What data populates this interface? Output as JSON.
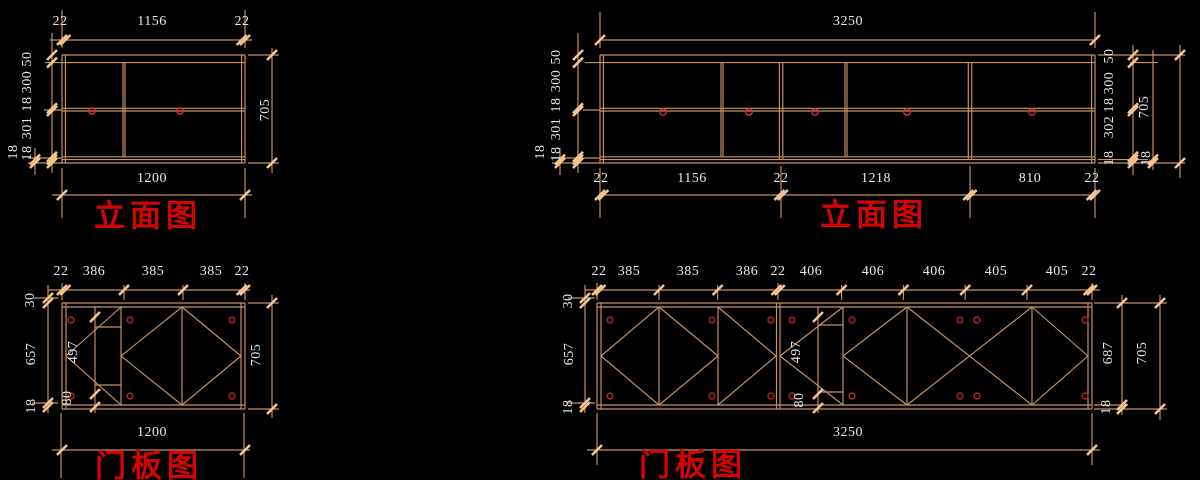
{
  "canvas": {
    "width": 1200,
    "height": 480,
    "background": "#000000"
  },
  "colors": {
    "line": "#C59468",
    "tick": "#F4C48F",
    "dim_text": "#E8E8E8",
    "title_red": "#D40404",
    "handle_red": "#D92B2B",
    "hinge_red": "#9E2323"
  },
  "titles": [
    {
      "text": "立面图",
      "x": 148,
      "y": 216
    },
    {
      "text": "立面图",
      "x": 874,
      "y": 215
    },
    {
      "text": "门板图",
      "x": 149,
      "y": 466
    },
    {
      "text": "门板图",
      "x": 693,
      "y": 465
    }
  ],
  "labels": [
    {
      "t": "22",
      "x": 60,
      "y": 22,
      "r": 0
    },
    {
      "t": "1156",
      "x": 152,
      "y": 22,
      "r": 0
    },
    {
      "t": "22",
      "x": 242,
      "y": 22,
      "r": 0
    },
    {
      "t": "50",
      "x": 28,
      "y": 59,
      "r": -90
    },
    {
      "t": "300",
      "x": 28,
      "y": 82,
      "r": -90
    },
    {
      "t": "18",
      "x": 28,
      "y": 104,
      "r": -90
    },
    {
      "t": "301",
      "x": 28,
      "y": 128,
      "r": -90
    },
    {
      "t": "18",
      "x": 28,
      "y": 153,
      "r": -90
    },
    {
      "t": "18",
      "x": 14,
      "y": 152,
      "r": -90
    },
    {
      "t": "705",
      "x": 266,
      "y": 110,
      "r": -90
    },
    {
      "t": "1200",
      "x": 152,
      "y": 179,
      "r": 0
    },
    {
      "t": "3250",
      "x": 848,
      "y": 22,
      "r": 0
    },
    {
      "t": "50",
      "x": 557,
      "y": 57,
      "r": -90
    },
    {
      "t": "300",
      "x": 557,
      "y": 81,
      "r": -90
    },
    {
      "t": "18",
      "x": 557,
      "y": 105,
      "r": -90
    },
    {
      "t": "301",
      "x": 557,
      "y": 129,
      "r": -90
    },
    {
      "t": "18",
      "x": 557,
      "y": 154,
      "r": -90
    },
    {
      "t": "18",
      "x": 541,
      "y": 152,
      "r": -90
    },
    {
      "t": "50",
      "x": 1110,
      "y": 56,
      "r": -90
    },
    {
      "t": "300",
      "x": 1110,
      "y": 83,
      "r": -90
    },
    {
      "t": "18",
      "x": 1110,
      "y": 105,
      "r": -90
    },
    {
      "t": "302",
      "x": 1110,
      "y": 127,
      "r": -90
    },
    {
      "t": "18",
      "x": 1110,
      "y": 158,
      "r": -90
    },
    {
      "t": "705",
      "x": 1145,
      "y": 107,
      "r": -90
    },
    {
      "t": "18",
      "x": 1147,
      "y": 158,
      "r": -90
    },
    {
      "t": "22",
      "x": 601,
      "y": 179,
      "r": 0
    },
    {
      "t": "1156",
      "x": 692,
      "y": 179,
      "r": 0
    },
    {
      "t": "22",
      "x": 781,
      "y": 179,
      "r": 0
    },
    {
      "t": "1218",
      "x": 876,
      "y": 179,
      "r": 0
    },
    {
      "t": "810",
      "x": 1030,
      "y": 179,
      "r": 0
    },
    {
      "t": "22",
      "x": 1092,
      "y": 179,
      "r": 0
    },
    {
      "t": "22",
      "x": 61,
      "y": 272,
      "r": 0
    },
    {
      "t": "386",
      "x": 94,
      "y": 272,
      "r": 0
    },
    {
      "t": "385",
      "x": 153,
      "y": 272,
      "r": 0
    },
    {
      "t": "385",
      "x": 211,
      "y": 272,
      "r": 0
    },
    {
      "t": "22",
      "x": 242,
      "y": 272,
      "r": 0
    },
    {
      "t": "30",
      "x": 31,
      "y": 300,
      "r": -90
    },
    {
      "t": "657",
      "x": 32,
      "y": 354,
      "r": -90
    },
    {
      "t": "18",
      "x": 32,
      "y": 406,
      "r": -90
    },
    {
      "t": "497",
      "x": 74,
      "y": 352,
      "r": -90
    },
    {
      "t": "80",
      "x": 68,
      "y": 398,
      "r": -90
    },
    {
      "t": "705",
      "x": 257,
      "y": 355,
      "r": -90
    },
    {
      "t": "1200",
      "x": 152,
      "y": 433,
      "r": 0
    },
    {
      "t": "22",
      "x": 599,
      "y": 272,
      "r": 0
    },
    {
      "t": "385",
      "x": 629,
      "y": 272,
      "r": 0
    },
    {
      "t": "385",
      "x": 688,
      "y": 272,
      "r": 0
    },
    {
      "t": "386",
      "x": 747,
      "y": 272,
      "r": 0
    },
    {
      "t": "22",
      "x": 778,
      "y": 272,
      "r": 0
    },
    {
      "t": "406",
      "x": 811,
      "y": 272,
      "r": 0
    },
    {
      "t": "406",
      "x": 873,
      "y": 272,
      "r": 0
    },
    {
      "t": "406",
      "x": 934,
      "y": 272,
      "r": 0
    },
    {
      "t": "405",
      "x": 996,
      "y": 272,
      "r": 0
    },
    {
      "t": "405",
      "x": 1057,
      "y": 272,
      "r": 0
    },
    {
      "t": "22",
      "x": 1089,
      "y": 272,
      "r": 0
    },
    {
      "t": "30",
      "x": 569,
      "y": 301,
      "r": -90
    },
    {
      "t": "657",
      "x": 570,
      "y": 354,
      "r": -90
    },
    {
      "t": "18",
      "x": 569,
      "y": 407,
      "r": -90
    },
    {
      "t": "497",
      "x": 797,
      "y": 352,
      "r": -90
    },
    {
      "t": "80",
      "x": 800,
      "y": 400,
      "r": -90
    },
    {
      "t": "687",
      "x": 1109,
      "y": 353,
      "r": -90
    },
    {
      "t": "18",
      "x": 1107,
      "y": 407,
      "r": -90
    },
    {
      "t": "705",
      "x": 1143,
      "y": 353,
      "r": -90
    },
    {
      "t": "3250",
      "x": 848,
      "y": 433,
      "r": 0
    }
  ],
  "lines": [
    [
      62,
      55,
      245,
      55
    ],
    [
      62,
      62.6,
      245,
      62.6
    ],
    [
      62,
      108.3,
      245,
      108.3
    ],
    [
      62,
      111,
      245,
      111
    ],
    [
      62,
      156.8,
      245,
      156.8
    ],
    [
      62,
      159.6,
      245,
      159.6
    ],
    [
      62,
      163,
      245,
      163
    ],
    [
      62,
      55,
      62,
      163
    ],
    [
      65.4,
      55,
      65.4,
      163
    ],
    [
      241.6,
      55,
      241.6,
      163
    ],
    [
      245,
      55,
      245,
      163
    ],
    [
      123,
      62.6,
      123,
      156.8
    ],
    [
      125,
      62.6,
      125,
      156.8
    ],
    [
      50,
      40,
      252,
      40
    ],
    [
      62,
      48,
      62,
      10
    ],
    [
      245,
      48,
      245,
      10
    ],
    [
      52,
      33,
      52,
      173
    ],
    [
      35,
      148,
      35,
      175
    ],
    [
      45,
      62.6,
      62,
      62.6
    ],
    [
      44,
      110,
      62,
      110
    ],
    [
      28,
      158,
      62,
      158
    ],
    [
      28,
      163,
      62,
      163
    ],
    [
      272,
      48,
      272,
      173
    ],
    [
      248,
      55,
      279,
      55
    ],
    [
      248,
      163,
      279,
      163
    ],
    [
      52,
      195,
      252,
      195
    ],
    [
      62,
      168,
      62,
      218
    ],
    [
      245,
      168,
      245,
      218
    ],
    [
      600,
      55,
      1095,
      55
    ],
    [
      600,
      62.6,
      1095,
      62.6
    ],
    [
      600,
      108.3,
      1095,
      108.3
    ],
    [
      600,
      111,
      1095,
      111
    ],
    [
      600,
      156.8,
      1095,
      156.8
    ],
    [
      600,
      159.6,
      1095,
      159.6
    ],
    [
      600,
      163,
      1095,
      163
    ],
    [
      600,
      55,
      600,
      163
    ],
    [
      603.4,
      55,
      603.4,
      163
    ],
    [
      1091.6,
      55,
      1091.6,
      163
    ],
    [
      1095,
      55,
      1095,
      163
    ],
    [
      721,
      62.6,
      721,
      156.8
    ],
    [
      723,
      62.6,
      723,
      156.8
    ],
    [
      845,
      62.6,
      845,
      156.8
    ],
    [
      847,
      62.6,
      847,
      156.8
    ],
    [
      779.4,
      62.6,
      779.4,
      159.6
    ],
    [
      782.8,
      62.6,
      782.8,
      159.6
    ],
    [
      968.3,
      62.6,
      968.3,
      159.6
    ],
    [
      971.7,
      62.6,
      971.7,
      159.6
    ],
    [
      600,
      40,
      1095,
      40
    ],
    [
      600,
      48,
      600,
      12
    ],
    [
      1095,
      48,
      1095,
      12
    ],
    [
      578,
      33,
      578,
      173
    ],
    [
      560,
      148,
      560,
      175
    ],
    [
      585,
      62.6,
      600,
      62.6
    ],
    [
      583,
      110,
      600,
      110
    ],
    [
      552,
      158,
      600,
      158
    ],
    [
      552,
      163,
      600,
      163
    ],
    [
      1133,
      45,
      1133,
      175
    ],
    [
      1153,
      50,
      1153,
      170
    ],
    [
      1180,
      45,
      1180,
      178
    ],
    [
      1098,
      55,
      1185,
      55
    ],
    [
      1130,
      62.6,
      1158,
      62.6
    ],
    [
      1098,
      163,
      1185,
      163
    ],
    [
      1098,
      159.6,
      1148,
      159.6
    ],
    [
      600,
      195,
      1095,
      195
    ],
    [
      600,
      168,
      600,
      218
    ],
    [
      781,
      166,
      781,
      218
    ],
    [
      970,
      166,
      970,
      218
    ],
    [
      1095,
      168,
      1095,
      218
    ],
    [
      62,
      303,
      245,
      303
    ],
    [
      62,
      307,
      245,
      307
    ],
    [
      62,
      405,
      245,
      405
    ],
    [
      62,
      409,
      245,
      409
    ],
    [
      62,
      303,
      62,
      409
    ],
    [
      66,
      303,
      66,
      409
    ],
    [
      241,
      303,
      241,
      409
    ],
    [
      245,
      303,
      245,
      409
    ],
    [
      95,
      307,
      95,
      413
    ],
    [
      121,
      307,
      121,
      405
    ],
    [
      182,
      307,
      182,
      405
    ],
    [
      95,
      327,
      121,
      327
    ],
    [
      95,
      385,
      121,
      385
    ],
    [
      66,
      356,
      121,
      307
    ],
    [
      66,
      356,
      121,
      405
    ],
    [
      121,
      356,
      182,
      307
    ],
    [
      182,
      307,
      241,
      356
    ],
    [
      241,
      356,
      182,
      405
    ],
    [
      182,
      405,
      121,
      356
    ],
    [
      48,
      290,
      250,
      290
    ],
    [
      62,
      300,
      62,
      283
    ],
    [
      124,
      300,
      124,
      285
    ],
    [
      183,
      300,
      183,
      285
    ],
    [
      245,
      300,
      245,
      283
    ],
    [
      48,
      285,
      48,
      413
    ],
    [
      34,
      298,
      58,
      298
    ],
    [
      32,
      403,
      58,
      403
    ],
    [
      272,
      295,
      272,
      418
    ],
    [
      248,
      303,
      279,
      303
    ],
    [
      248,
      409,
      279,
      409
    ],
    [
      52,
      450,
      250,
      450
    ],
    [
      61,
      413,
      61,
      478
    ],
    [
      244,
      413,
      244,
      478
    ],
    [
      597,
      303,
      1092,
      303
    ],
    [
      597,
      307,
      1092,
      307
    ],
    [
      597,
      405,
      1092,
      405
    ],
    [
      597,
      409,
      1092,
      409
    ],
    [
      597,
      303,
      597,
      409
    ],
    [
      601,
      303,
      601,
      409
    ],
    [
      1088,
      303,
      1088,
      409
    ],
    [
      1092,
      303,
      1092,
      409
    ],
    [
      659,
      307,
      659,
      405
    ],
    [
      718,
      307,
      718,
      405
    ],
    [
      776.5,
      303,
      776.5,
      409
    ],
    [
      780,
      303,
      780,
      409
    ],
    [
      818,
      307,
      818,
      413
    ],
    [
      843,
      307,
      843,
      405
    ],
    [
      907,
      307,
      907,
      405
    ],
    [
      1032,
      307,
      1032,
      405
    ],
    [
      818,
      325,
      843,
      325
    ],
    [
      818,
      392,
      843,
      392
    ],
    [
      601,
      356,
      659,
      307
    ],
    [
      659,
      307,
      718,
      356
    ],
    [
      718,
      356,
      659,
      405
    ],
    [
      659,
      405,
      601,
      356
    ],
    [
      718,
      307,
      776,
      356
    ],
    [
      718,
      405,
      776,
      356
    ],
    [
      780,
      356,
      843,
      307
    ],
    [
      780,
      356,
      843,
      405
    ],
    [
      843,
      356,
      907,
      307
    ],
    [
      843,
      356,
      907,
      405
    ],
    [
      907,
      307,
      1032,
      405
    ],
    [
      907,
      405,
      1032,
      307
    ],
    [
      1032,
      307,
      1088,
      356
    ],
    [
      1032,
      405,
      1088,
      356
    ],
    [
      585,
      290,
      1100,
      290
    ],
    [
      597,
      300,
      597,
      283
    ],
    [
      659,
      300,
      659,
      285
    ],
    [
      717.6,
      300,
      717.6,
      285
    ],
    [
      778,
      300,
      778,
      283
    ],
    [
      841.6,
      300,
      841.6,
      285
    ],
    [
      903.4,
      300,
      903.4,
      285
    ],
    [
      965.2,
      300,
      965.2,
      285
    ],
    [
      1027,
      300,
      1027,
      285
    ],
    [
      1092,
      300,
      1092,
      283
    ],
    [
      585,
      285,
      585,
      413
    ],
    [
      568,
      298,
      595,
      298
    ],
    [
      566,
      403,
      595,
      403
    ],
    [
      1122,
      295,
      1122,
      415
    ],
    [
      1160,
      295,
      1160,
      420
    ],
    [
      1094,
      303,
      1167,
      303
    ],
    [
      1094,
      405,
      1128,
      405
    ],
    [
      1094,
      409,
      1167,
      409
    ],
    [
      587,
      450,
      1100,
      450
    ],
    [
      597,
      413,
      597,
      465
    ],
    [
      1092,
      413,
      1092,
      465
    ]
  ],
  "ticks": [
    [
      62,
      40
    ],
    [
      65.4,
      40
    ],
    [
      241.6,
      40
    ],
    [
      245,
      40
    ],
    [
      52,
      55
    ],
    [
      52,
      62.6
    ],
    [
      52,
      108.3
    ],
    [
      52,
      111
    ],
    [
      52,
      156.8
    ],
    [
      52,
      159.6
    ],
    [
      52,
      163
    ],
    [
      35,
      159.6
    ],
    [
      35,
      163
    ],
    [
      272,
      55
    ],
    [
      272,
      163
    ],
    [
      62,
      195
    ],
    [
      245,
      195
    ],
    [
      600,
      40
    ],
    [
      1095,
      40
    ],
    [
      578,
      55
    ],
    [
      578,
      62.6
    ],
    [
      578,
      108.3
    ],
    [
      578,
      111
    ],
    [
      578,
      156.8
    ],
    [
      578,
      159.6
    ],
    [
      578,
      163
    ],
    [
      560,
      159.6
    ],
    [
      560,
      163
    ],
    [
      1133,
      55
    ],
    [
      1133,
      62.6
    ],
    [
      1133,
      108.3
    ],
    [
      1133,
      111
    ],
    [
      1133,
      156.8
    ],
    [
      1133,
      159.6
    ],
    [
      1133,
      163
    ],
    [
      1153,
      159.6
    ],
    [
      1153,
      163
    ],
    [
      1180,
      55
    ],
    [
      1180,
      163
    ],
    [
      600,
      195
    ],
    [
      603.4,
      195
    ],
    [
      779.4,
      195
    ],
    [
      782.8,
      195
    ],
    [
      968.3,
      195
    ],
    [
      971.7,
      195
    ],
    [
      1091.6,
      195
    ],
    [
      1095,
      195
    ],
    [
      62,
      290
    ],
    [
      65.4,
      290
    ],
    [
      124,
      290
    ],
    [
      183,
      290
    ],
    [
      241.6,
      290
    ],
    [
      245,
      290
    ],
    [
      48,
      298
    ],
    [
      48,
      303
    ],
    [
      48,
      403
    ],
    [
      48,
      407
    ],
    [
      95,
      317
    ],
    [
      95,
      394
    ],
    [
      95,
      407
    ],
    [
      272,
      303
    ],
    [
      272,
      409
    ],
    [
      62,
      450
    ],
    [
      245,
      450
    ],
    [
      597,
      290
    ],
    [
      600.4,
      290
    ],
    [
      659,
      290
    ],
    [
      717.6,
      290
    ],
    [
      776.4,
      290
    ],
    [
      779.8,
      290
    ],
    [
      841.6,
      290
    ],
    [
      903.4,
      290
    ],
    [
      965.2,
      290
    ],
    [
      1027,
      290
    ],
    [
      1088.6,
      290
    ],
    [
      1092,
      290
    ],
    [
      585,
      298
    ],
    [
      585,
      303
    ],
    [
      585,
      403
    ],
    [
      585,
      407
    ],
    [
      818,
      317
    ],
    [
      818,
      394
    ],
    [
      818,
      408
    ],
    [
      1122,
      303
    ],
    [
      1122,
      405
    ],
    [
      1122,
      409
    ],
    [
      1160,
      303
    ],
    [
      1160,
      409
    ],
    [
      597,
      450
    ],
    [
      1092,
      450
    ]
  ],
  "handles": [
    [
      92,
      111
    ],
    [
      180,
      111
    ],
    [
      663,
      112
    ],
    [
      749,
      112
    ],
    [
      815,
      112
    ],
    [
      907,
      112
    ],
    [
      1032,
      112
    ]
  ],
  "hinges": [
    [
      71,
      320
    ],
    [
      130,
      320
    ],
    [
      232,
      320
    ],
    [
      71,
      396
    ],
    [
      130,
      396
    ],
    [
      232,
      396
    ],
    [
      610,
      320
    ],
    [
      712,
      320
    ],
    [
      771,
      320
    ],
    [
      792,
      320
    ],
    [
      852,
      320
    ],
    [
      960,
      320
    ],
    [
      977,
      320
    ],
    [
      1085,
      320
    ],
    [
      610,
      396
    ],
    [
      712,
      396
    ],
    [
      771,
      396
    ],
    [
      792,
      396
    ],
    [
      852,
      396
    ],
    [
      960,
      396
    ],
    [
      977,
      396
    ],
    [
      1085,
      396
    ]
  ]
}
